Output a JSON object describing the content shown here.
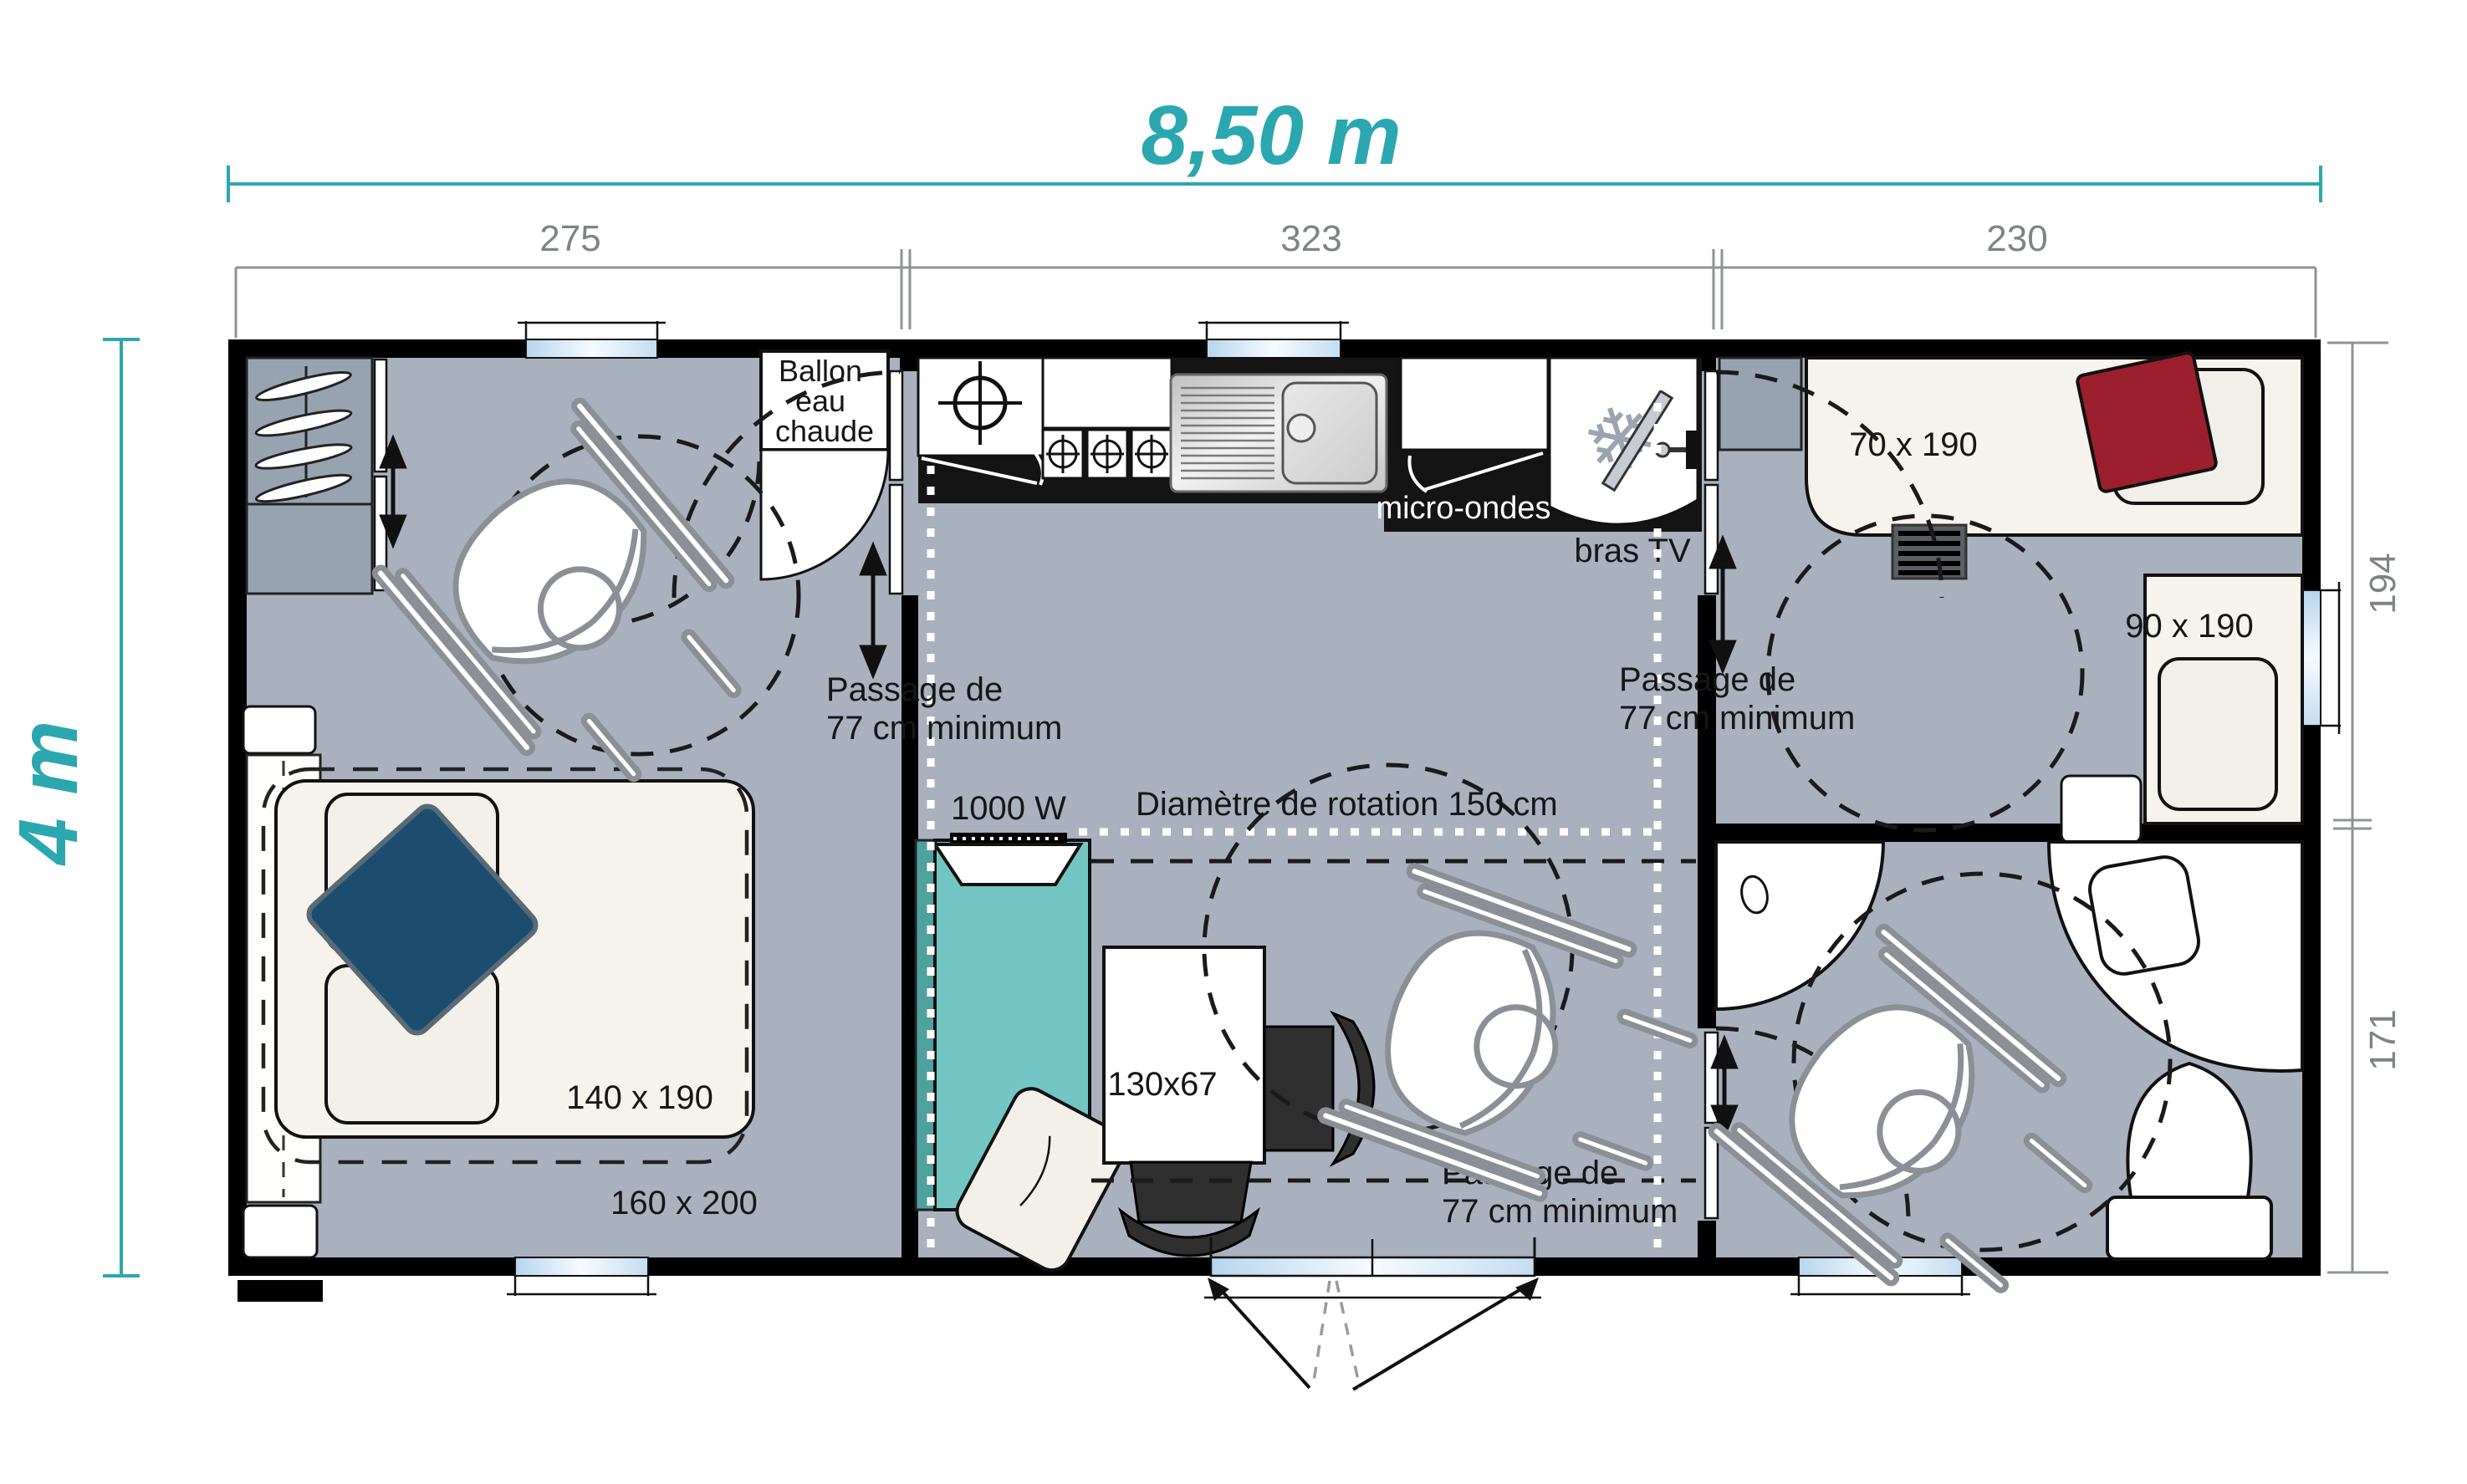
{
  "dimensions": {
    "width_label": "8,50 m",
    "height_label": "4 m",
    "top_segments": [
      "275",
      "323",
      "230"
    ],
    "right_segments": [
      "194",
      "171"
    ]
  },
  "labels": {
    "water_heater_line1": "Ballon",
    "water_heater_line2": "eau",
    "water_heater_line3": "chaude",
    "microwave": "micro-ondes",
    "tv_arm": "bras TV",
    "bed_70": "70 x 190",
    "bed_90": "90 x 190",
    "bed_140": "140 x 190",
    "bed_160": "160 x 200",
    "table": "130x67",
    "heater": "1000 W",
    "rotation_diameter": "Diamètre de rotation 150 cm",
    "passage_line1": "Passage de",
    "passage_line2": "77 cm minimum"
  },
  "icons": {
    "snowflake_icon": "❄"
  },
  "colors": {
    "accent_teal": "#2ba7b0",
    "dimension_gray": "#8f9397",
    "floor_gray": "#a9b1bf",
    "wall_black": "#000000",
    "wardrobe_gray": "#98a3b1",
    "furniture_cream": "#f5f3eb",
    "sofa_teal": "#73c5c3",
    "sofa_teal_dark": "#4fa19f",
    "cushion_blue": "#1d4d6e",
    "cushion_red": "#9c1f2d",
    "window_blue": "#bcd9f0",
    "counter_black": "#141414"
  }
}
